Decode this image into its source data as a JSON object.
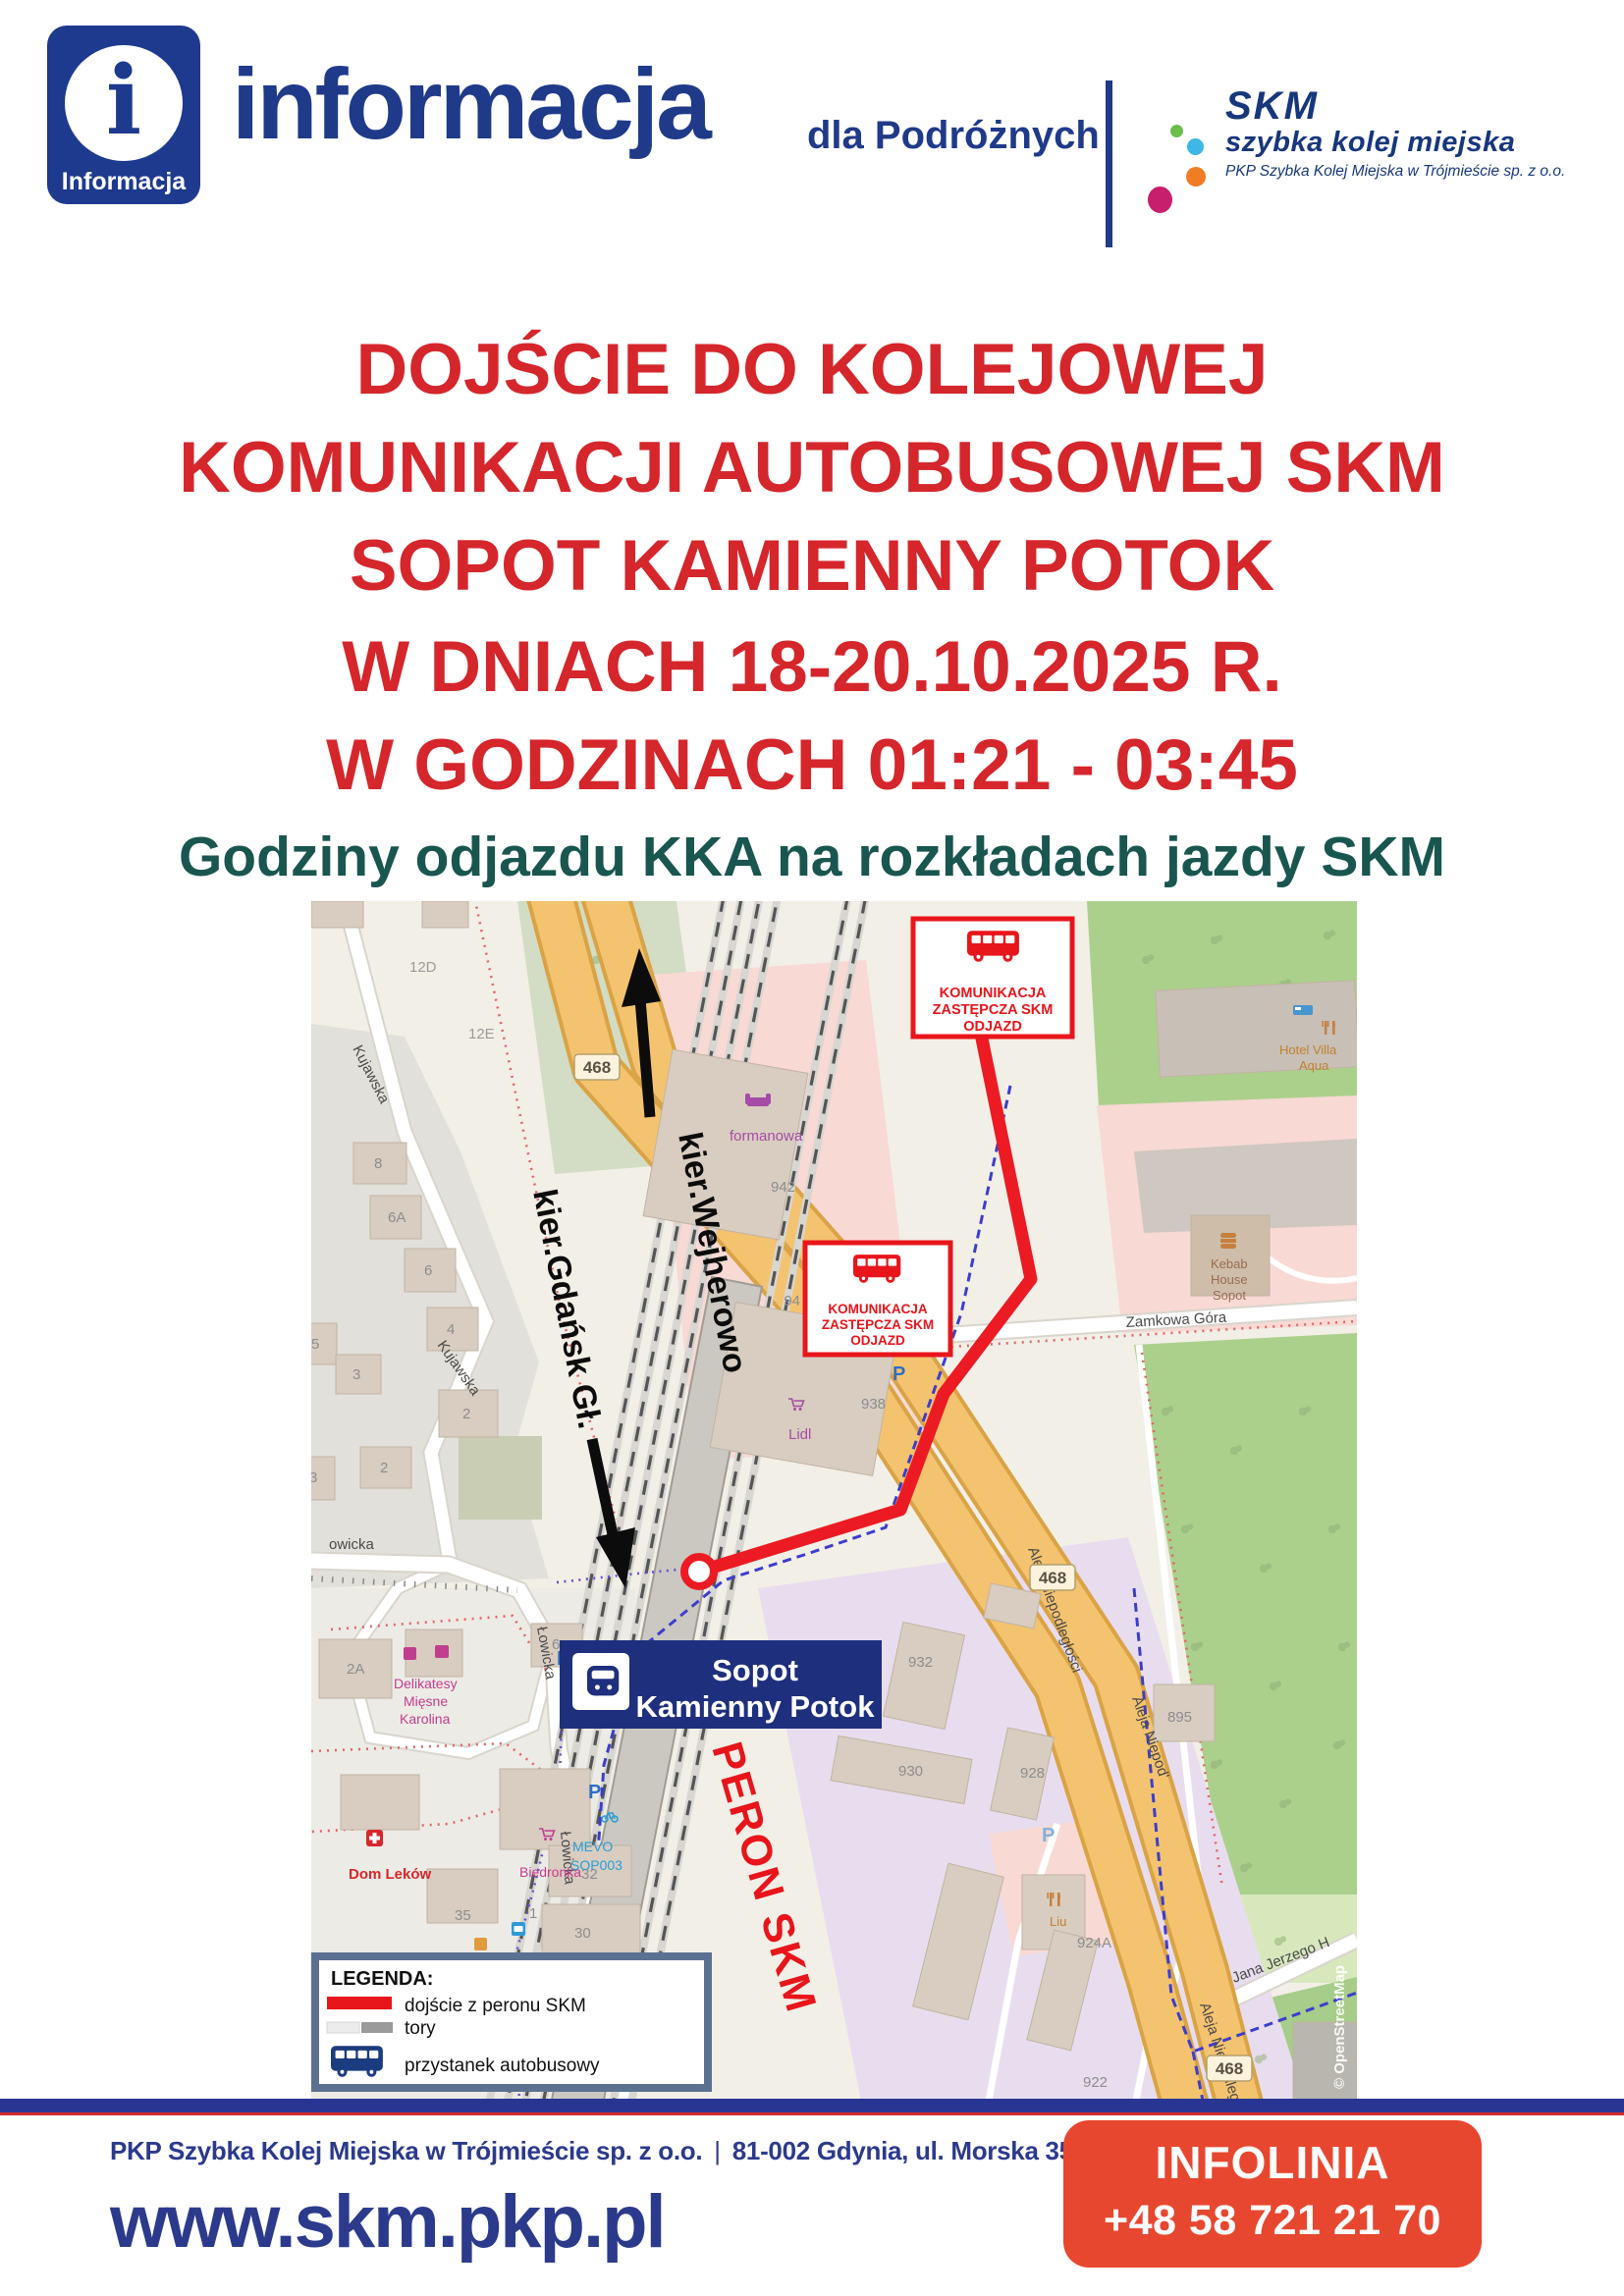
{
  "colors": {
    "navy": "#203a8a",
    "title_red": "#d5262c",
    "teal": "#19564f",
    "route_red": "#ec1b23",
    "infoline_red": "#e8472f",
    "legend_border": "#5b7191"
  },
  "header": {
    "info_icon_letter": "i",
    "info_icon_caption": "Informacja",
    "brand": "informacja",
    "brand_suffix": "dla Podróżnych",
    "skm": {
      "name": "SKM",
      "tagline": "szybka kolej miejska",
      "company": "PKP Szybka Kolej Miejska w Trójmieście sp. z o.o."
    }
  },
  "title": {
    "line1": "DOJŚCIE DO KOLEJOWEJ",
    "line2": "KOMUNIKACJI AUTOBUSOWEJ SKM",
    "line3": "SOPOT KAMIENNY POTOK",
    "line4": "W DNIACH 18-20.10.2025 R.",
    "line5": "W GODZINACH 01:21 - 03:45"
  },
  "subtitle": "Godziny odjazdu KKA na rozkładach jazdy SKM",
  "map": {
    "replacement_box": {
      "line1": "KOMUNIKACJA",
      "line2": "ZASTĘPCZA SKM",
      "line3": "ODJAZD"
    },
    "station": {
      "line1": "Sopot",
      "line2": "Kamienny Potok"
    },
    "peron": "PERON SKM",
    "dir_wejherowo": "kier.Wejherowo",
    "dir_gdansk": "kier.Gdańsk Gł.",
    "shield": "468",
    "streets": {
      "kujawska": "Kujawska",
      "lowicka": "Łowicka",
      "owicka": "owicka",
      "zamkowa": "Zamkowa Góra",
      "aleja": "Aleja Niepodległości",
      "aleja2": "Aleja Niepod'",
      "aleja3": "Aleja Niepodleg",
      "jana": "Jana Jerzego H"
    },
    "numbers": {
      "n12d": "12D",
      "n12e": "12E",
      "n8": "8",
      "n6a": "6A",
      "n6": "6",
      "n4": "4",
      "n3": "3",
      "n5": "5",
      "n2": "2",
      "n2b": "2",
      "n3b": "3",
      "n2a": "2A",
      "n6b": "6",
      "n942": "942",
      "n94": "94",
      "n938": "938",
      "n932": "932",
      "n930": "930",
      "n928": "928",
      "n924a": "924A",
      "n922": "922",
      "n895": "895",
      "n35": "35",
      "n30": "30",
      "n32": "32",
      "n1": "1"
    },
    "pois": {
      "formanowa": "formanowa",
      "lidl": "Lidl",
      "delikatesy1": "Delikatesy",
      "delikatesy2": "Mięsne",
      "delikatesy3": "Karolina",
      "domlekow": "Dom Leków",
      "biedronka": "Biedronka",
      "mevo1": "MEVO",
      "mevo2": "SOP003",
      "kebab1": "Kebab",
      "kebab2": "House",
      "kebab3": "Sopot",
      "hotel1": "Hotel Villa",
      "hotel2": "Aqua",
      "liu": "Liu",
      "parking": "P"
    },
    "attribution": "© OpenStreetMap",
    "legend": {
      "title": "LEGENDA:",
      "item1": "dojście z peronu SKM",
      "item2": "tory",
      "item3": "przystanek autobusowy"
    }
  },
  "footer": {
    "company_line": "PKP Szybka Kolej Miejska w Trójmieście sp. z o.o.",
    "separator": "|",
    "address": "81-002 Gdynia, ul. Morska 350A",
    "website": "www.skm.pkp.pl",
    "infoline_label": "INFOLINIA",
    "infoline_number": "+48 58 721 21 70"
  }
}
